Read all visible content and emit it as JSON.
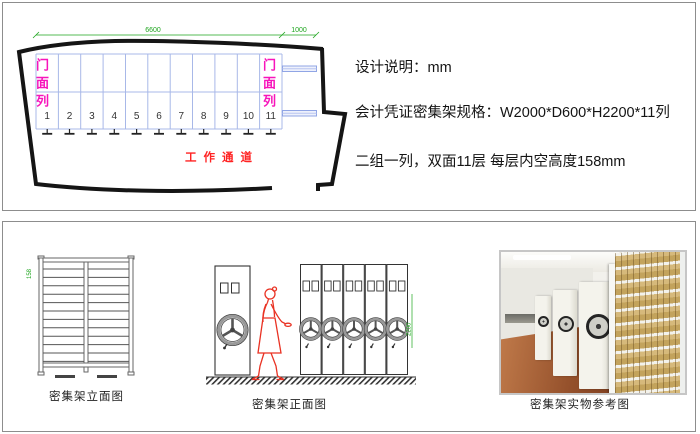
{
  "top_panel": {
    "floor_plan": {
      "dim_main": "6600",
      "dim_right": "1000",
      "front_col_left": "门面列",
      "front_col_right": "门面列",
      "columns": [
        "1",
        "2",
        "3",
        "4",
        "5",
        "6",
        "7",
        "8",
        "9",
        "10",
        "11"
      ],
      "aisle": "工作通道"
    },
    "notes": {
      "line1": "设计说明：mm",
      "line2": "会计凭证密集架规格：W2000*D600*H2200*11列",
      "line3": "二组一列，双面11层  每层内空高度158mm"
    }
  },
  "bottom_panel": {
    "elevation": {
      "caption": "密集架立面图",
      "dim_label": "158"
    },
    "front_view": {
      "caption": "密集架正面图",
      "dim_label": "2200"
    },
    "photo": {
      "caption": "密集架实物参考图"
    }
  },
  "colors": {
    "outline": "#151515",
    "grid_line": "#a8b8e8",
    "dimension_green": "#1ea51e",
    "front_col_pink": "#f715bb",
    "aisle_red": "#ff2222",
    "shelf_boxes_tan": "#d6b97b",
    "floor_wood": "#94502b"
  }
}
